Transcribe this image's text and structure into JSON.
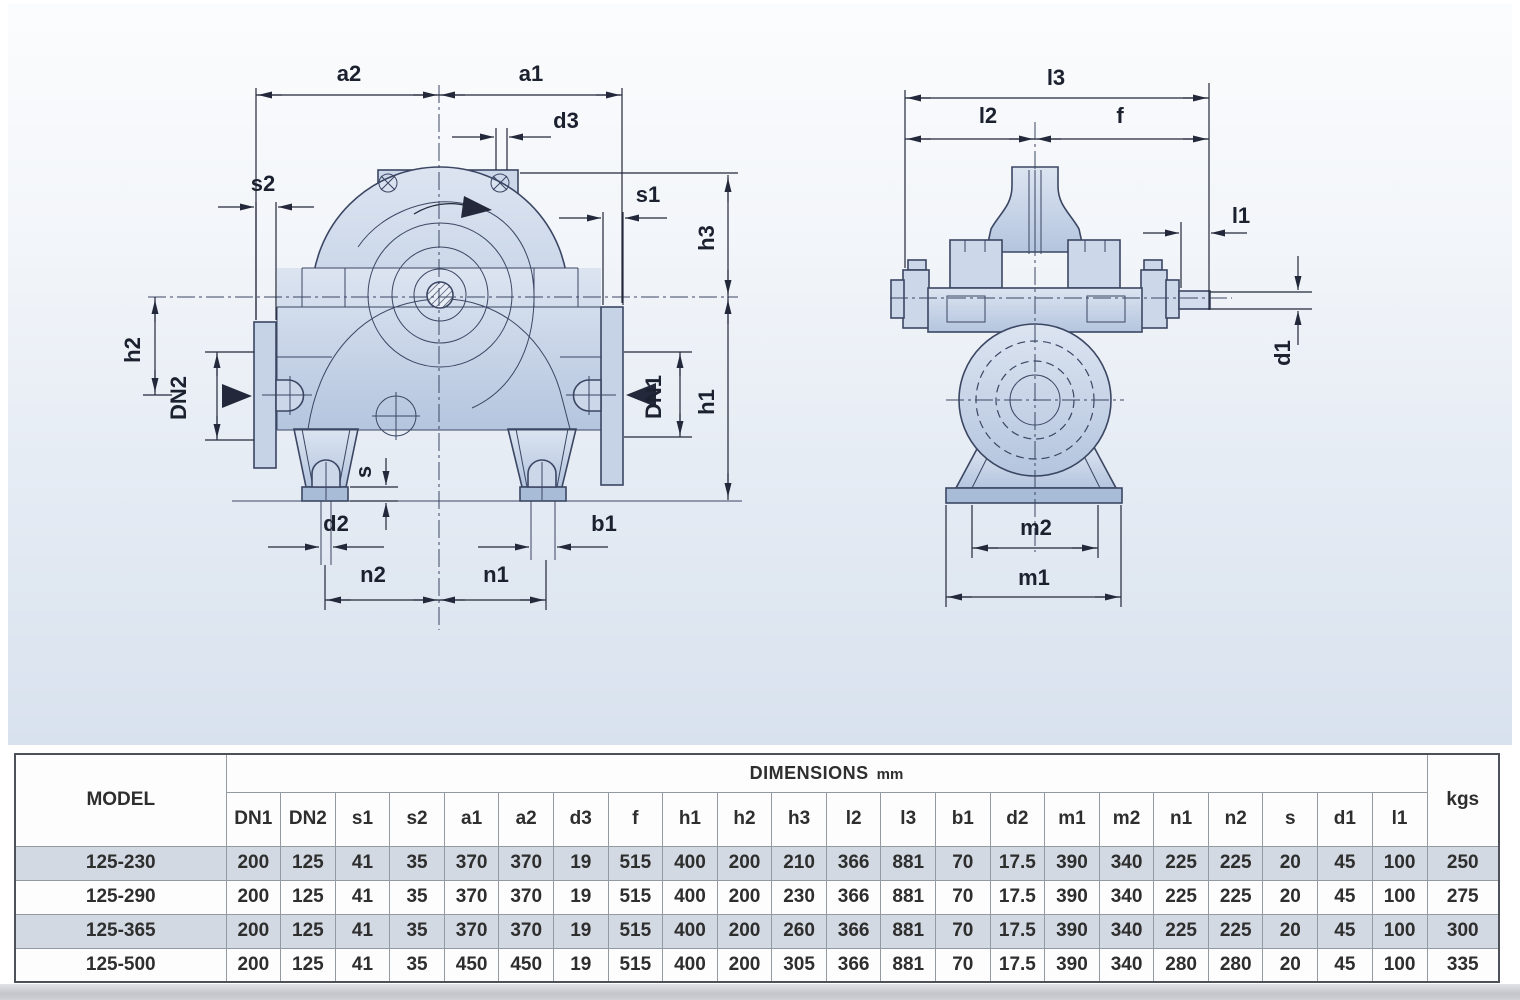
{
  "diagram": {
    "line_color": "#3b4663",
    "dim_color": "#23283a",
    "body_fill_top": "#dce4f1",
    "body_fill_bottom": "#b4c5de",
    "front_labels": [
      {
        "t": "a2",
        "x": 349,
        "y": 81
      },
      {
        "t": "a1",
        "x": 531,
        "y": 81
      },
      {
        "t": "d3",
        "x": 566,
        "y": 128
      },
      {
        "t": "s2",
        "x": 263,
        "y": 191
      },
      {
        "t": "s1",
        "x": 648,
        "y": 202
      },
      {
        "t": "h3",
        "x": 714,
        "y": 238,
        "r": -90
      },
      {
        "t": "h2",
        "x": 140,
        "y": 350,
        "r": -90
      },
      {
        "t": "DN2",
        "x": 186,
        "y": 398,
        "r": -90
      },
      {
        "t": "DN1",
        "x": 661,
        "y": 397,
        "r": -90
      },
      {
        "t": "h1",
        "x": 714,
        "y": 402,
        "r": -90
      },
      {
        "t": "s",
        "x": 371,
        "y": 472,
        "r": -90
      },
      {
        "t": "d2",
        "x": 336,
        "y": 531
      },
      {
        "t": "b1",
        "x": 604,
        "y": 531
      },
      {
        "t": "n2",
        "x": 373,
        "y": 582
      },
      {
        "t": "n1",
        "x": 496,
        "y": 582
      }
    ],
    "side_labels": [
      {
        "t": "l3",
        "x": 1056,
        "y": 85
      },
      {
        "t": "l2",
        "x": 988,
        "y": 123
      },
      {
        "t": "f",
        "x": 1120,
        "y": 123
      },
      {
        "t": "l1",
        "x": 1241,
        "y": 223
      },
      {
        "t": "d1",
        "x": 1290,
        "y": 353,
        "r": -90
      },
      {
        "t": "m2",
        "x": 1036,
        "y": 535
      },
      {
        "t": "m1",
        "x": 1034,
        "y": 585
      }
    ]
  },
  "table": {
    "model_header": "MODEL",
    "dimensions_header": "DIMENSIONS",
    "dimensions_unit": "mm",
    "weight_header": "kgs",
    "columns": [
      "DN1",
      "DN2",
      "s1",
      "s2",
      "a1",
      "a2",
      "d3",
      "f",
      "h1",
      "h2",
      "h3",
      "l2",
      "l3",
      "b1",
      "d2",
      "m1",
      "m2",
      "n1",
      "n2",
      "s",
      "d1",
      "l1"
    ],
    "rows": [
      {
        "model": "125-230",
        "values": [
          "200",
          "125",
          "41",
          "35",
          "370",
          "370",
          "19",
          "515",
          "400",
          "200",
          "210",
          "366",
          "881",
          "70",
          "17.5",
          "390",
          "340",
          "225",
          "225",
          "20",
          "45",
          "100"
        ],
        "kgs": "250",
        "shaded": true
      },
      {
        "model": "125-290",
        "values": [
          "200",
          "125",
          "41",
          "35",
          "370",
          "370",
          "19",
          "515",
          "400",
          "200",
          "230",
          "366",
          "881",
          "70",
          "17.5",
          "390",
          "340",
          "225",
          "225",
          "20",
          "45",
          "100"
        ],
        "kgs": "275",
        "shaded": false
      },
      {
        "model": "125-365",
        "values": [
          "200",
          "125",
          "41",
          "35",
          "370",
          "370",
          "19",
          "515",
          "400",
          "200",
          "260",
          "366",
          "881",
          "70",
          "17.5",
          "390",
          "340",
          "225",
          "225",
          "20",
          "45",
          "100"
        ],
        "kgs": "300",
        "shaded": true
      },
      {
        "model": "125-500",
        "values": [
          "200",
          "125",
          "41",
          "35",
          "450",
          "450",
          "19",
          "515",
          "400",
          "200",
          "305",
          "366",
          "881",
          "70",
          "17.5",
          "390",
          "340",
          "280",
          "280",
          "20",
          "45",
          "100"
        ],
        "kgs": "335",
        "shaded": false
      }
    ]
  }
}
